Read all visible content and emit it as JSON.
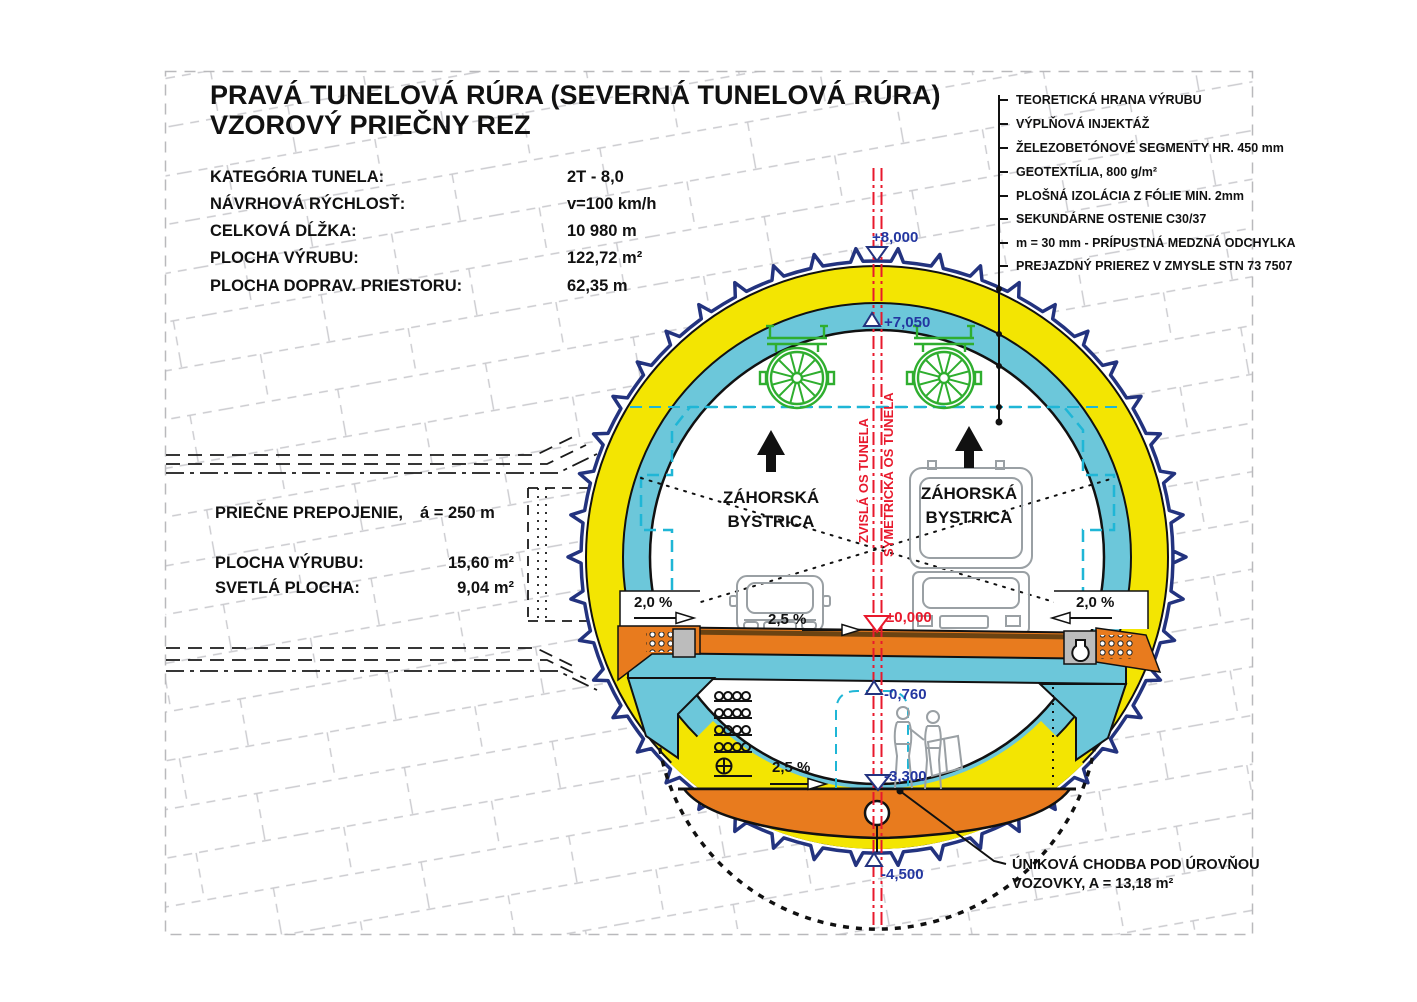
{
  "title": {
    "line1": "PRAVÁ TUNELOVÁ RÚRA (SEVERNÁ TUNELOVÁ RÚRA)",
    "line2": "VZOROVÝ PRIEČNY REZ"
  },
  "parameters": [
    {
      "label": "KATEGÓRIA TUNELA:",
      "value": "2T - 8,0"
    },
    {
      "label": "NÁVRHOVÁ RÝCHLOSŤ:",
      "value": "v=100 km/h"
    },
    {
      "label": "CELKOVÁ DĹŽKA:",
      "value": "10 980 m"
    },
    {
      "label": "PLOCHA VÝRUBU:",
      "value": "122,72 m²"
    },
    {
      "label": "PLOCHA DOPRAV. PRIESTORU:",
      "value": "62,35 m"
    }
  ],
  "legend_items": [
    "TEORETICKÁ HRANA VÝRUBU",
    "VÝPLŇOVÁ INJEKTÁŽ",
    "ŽELEZOBETÓNOVÉ SEGMENTY HR. 450 mm",
    "GEOTEXTÍLIA, 800 g/m²",
    "PLOŠNÁ IZOLÁCIA Z FÓLIE MIN. 2mm",
    "SEKUNDÁRNE OSTENIE C30/37",
    "m = 30 mm - PRÍPUSTNÁ MEDZNÁ ODCHYLKA",
    "PREJAZDNÝ PRIEREZ V ZMYSLE STN 73 7507"
  ],
  "cross_passage": {
    "heading": "PRIEČNE PREPOJENIE,",
    "spacing": "á = 250 m",
    "rows": [
      {
        "label": "PLOCHA VÝRUBU:",
        "value": "15,60 m²"
      },
      {
        "label": "SVETLÁ PLOCHA:",
        "value": "9,04 m²"
      }
    ]
  },
  "axis": {
    "vertical_label": "ZVISLÁ OS TUNELA",
    "symmetry_label": "SYMETRICKÁ OS TUNELA"
  },
  "directions": {
    "left": {
      "line1": "ZÁHORSKÁ",
      "line2": "BYSTRICA"
    },
    "right": {
      "line1": "ZÁHORSKÁ",
      "line2": "BYSTRICA"
    }
  },
  "levels": {
    "crown": "+8,000",
    "lining_top": "+7,050",
    "road": "±0,000",
    "gallery_ceiling": "-0,760",
    "gallery_floor": "-3,300",
    "invert_bottom": "-4,500"
  },
  "slopes": {
    "edge_left": "2,0 %",
    "roadway": "2,5 %",
    "edge_right": "2,0 %",
    "gallery": "2,5 %"
  },
  "escape_note": {
    "line1": "ÚNIKOVÁ CHODBA POD ÚROVŇOU",
    "line2": "VOZOVKY, A = 13,18 m²"
  },
  "colors": {
    "excavation_navy": "#23337f",
    "lining_yellow": "#f3e502",
    "segment_cyan": "#6cc7da",
    "road_orange": "#e87b1e",
    "axis_red": "#e8192c",
    "fan_green": "#2fae2f",
    "level_text_blue": "#2336a0",
    "clearance_cyan": "#1fb6d6"
  }
}
